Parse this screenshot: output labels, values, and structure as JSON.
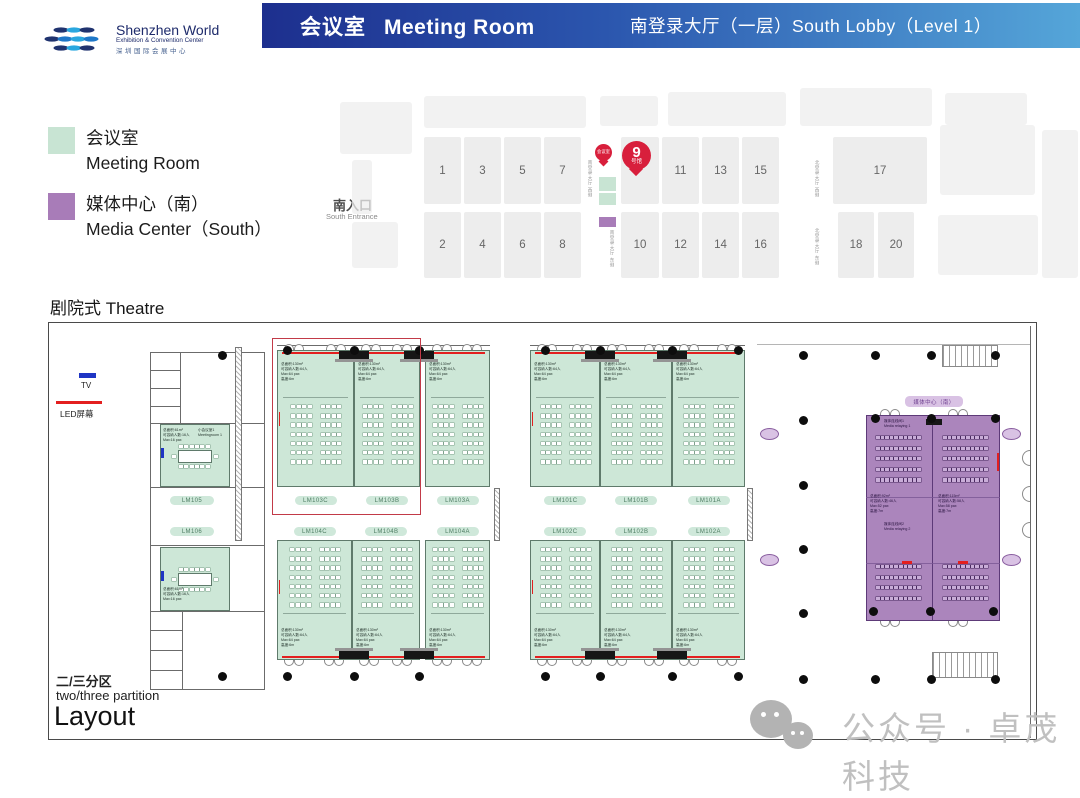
{
  "header": {
    "logo": {
      "name": "Shenzhen World",
      "tagline": "Exhibition & Convention Center",
      "tagline_cn": "深圳国际会展中心"
    },
    "banner": {
      "title_cn": "会议室",
      "title_en": "Meeting Room",
      "location": "南登录大厅（一层）South Lobby（Level 1）"
    }
  },
  "legend": {
    "meeting_room": {
      "label_cn": "会议室",
      "label_en": "Meeting Room",
      "color": "#c8e4d3"
    },
    "media_center": {
      "label_cn": "媒体中心（南）",
      "label_en": "Media Center（South）",
      "color": "#a87cb8"
    }
  },
  "overview": {
    "entrance_cn": "南入口",
    "entrance_en": "South Entrance",
    "pin_small_label": "会议室",
    "pin_big_number": "9",
    "pin_big_suffix": "号馆",
    "corridor_labels": [
      "南登录大厅 西侧",
      "南登录大厅 东侧",
      "北登录大厅 西侧",
      "北登录大厅 东侧"
    ],
    "halls_top": [
      "1",
      "3",
      "5",
      "7",
      "11",
      "13",
      "15",
      "17"
    ],
    "halls_bottom": [
      "2",
      "4",
      "6",
      "8",
      "10",
      "12",
      "14",
      "16",
      "18",
      "20"
    ]
  },
  "plan": {
    "title": "剧院式 Theatre",
    "tv_label": "TV",
    "led_label": "LED屏幕",
    "partition_cn": "二/三分区",
    "partition_en": "two/three partition",
    "layout_label": "Layout",
    "theatre_rooms": [
      "LM103C",
      "LM103B",
      "LM103A",
      "LM104C",
      "LM104B",
      "LM104A",
      "LM101C",
      "LM101B",
      "LM101A",
      "LM102C",
      "LM102B",
      "LM102A"
    ],
    "room_spec": [
      "总面积:130m²",
      "可容纳人数:64人",
      "Max:64 pax",
      "高度:6m"
    ],
    "small_rooms": [
      {
        "id": "LM105",
        "name_cn": "小会议室1",
        "name_en": "Meetingroom 1",
        "spec": [
          "总面积:61m²",
          "可容纳人数:16人",
          "Max:16 pax"
        ]
      },
      {
        "id": "LM106",
        "name_cn": "",
        "name_en": "",
        "spec": [
          "总面积:61m²",
          "可容纳人数:16人",
          "Max:16 pax"
        ]
      }
    ],
    "media_center": {
      "pill": "媒体中心（南）",
      "room1_cn": "媒体连线间1",
      "room1_en": "Media relaying 1",
      "room2_cn": "媒体连线间2",
      "room2_en": "Media relaying 2",
      "spec_left": [
        "总面积:92m²",
        "可容纳人数:46人",
        "Max:52 pax",
        "高度:7m"
      ],
      "spec_right": [
        "总面积:115m²",
        "可容纳人数:58人",
        "Max:58 pax",
        "高度:7m"
      ]
    }
  },
  "watermark": {
    "text": "公众号 · 卓茂科技"
  }
}
